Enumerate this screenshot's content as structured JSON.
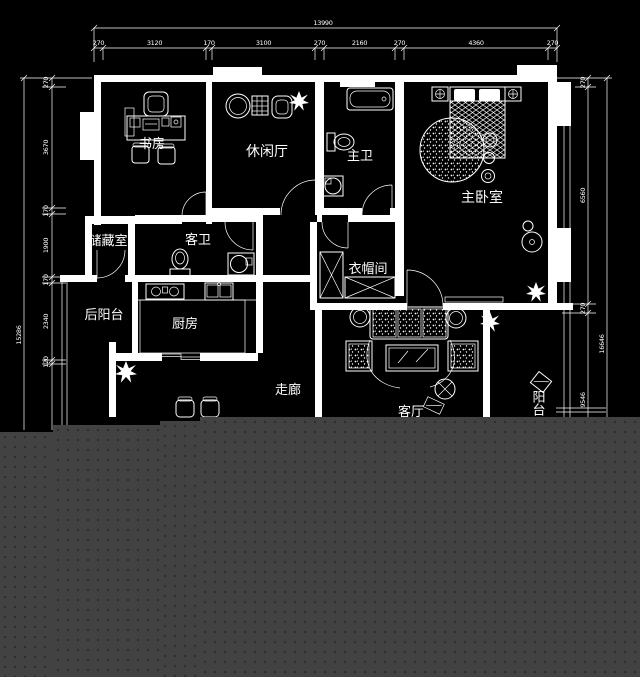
{
  "colors": {
    "background": "#000000",
    "linework": "#ffffff",
    "placeholder_panel": "#424242",
    "placeholder_dots": "#2e2e2e"
  },
  "rooms": {
    "study": {
      "label": "书房"
    },
    "lounge": {
      "label": "休闲厅"
    },
    "master_bath": {
      "label": "主卫"
    },
    "master_bedroom": {
      "label": "主卧室"
    },
    "storage": {
      "label": "储藏室"
    },
    "guest_bath": {
      "label": "客卫"
    },
    "cloakroom": {
      "label": "衣帽间"
    },
    "back_balcony": {
      "label": "后阳台"
    },
    "kitchen": {
      "label": "厨房"
    },
    "corridor": {
      "label": "走廊"
    },
    "living_room": {
      "label": "客厅"
    },
    "balcony": {
      "label": "阳台"
    }
  },
  "dimensions": {
    "top": {
      "total": "13990",
      "segments": [
        "270",
        "3120",
        "170",
        "3100",
        "270",
        "2160",
        "270",
        "4360",
        "270"
      ]
    },
    "left": {
      "total": "15286",
      "segments": [
        "270",
        "3670",
        "170",
        "1900",
        "170",
        "2340",
        "120"
      ]
    },
    "right": {
      "total": "16646",
      "segments": [
        "270",
        "6560",
        "270",
        "9546"
      ]
    }
  }
}
